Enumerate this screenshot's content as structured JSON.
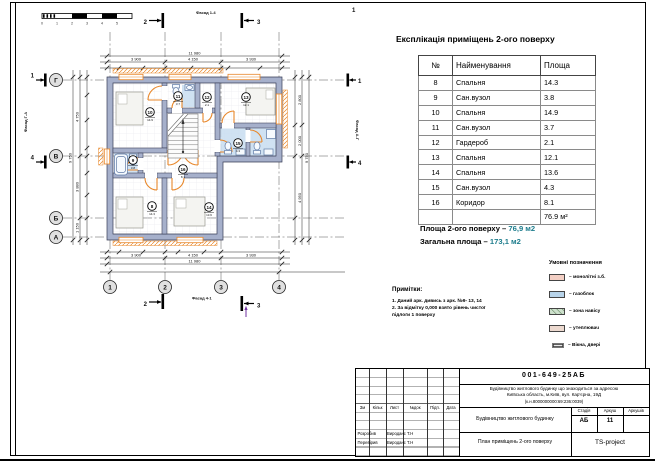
{
  "sheet": {
    "doc_code": "001-649-25АБ",
    "address_line1": "Будівництво житлового будинку що знаходиться за адресою",
    "address_line2": "Київська область, м.Київ, вул. Кар'єрна, 19Д",
    "address_line3": "(к.н.8000000000:69:236:0039)",
    "object_name": "Будівництво житлового будинку",
    "drawing_title": "План приміщень 2-ого поверху",
    "company": "TS-project",
    "stage_label": "Стадія",
    "sheet_label": "Аркуш",
    "sheets_label": "Аркушів",
    "stage": "АБ",
    "sheet_no": "11",
    "rev_cols": [
      "Зм",
      "Кільк",
      "Лист",
      "№док",
      "Підп.",
      "Дата"
    ],
    "roles": [
      {
        "role": "Розробив",
        "name": "Вироданс Т.Н"
      },
      {
        "role": "Перевірив",
        "name": "Вироданс Т.Н"
      }
    ]
  },
  "table": {
    "title": "Експлікація приміщень 2-ого поверху",
    "headers": [
      "№",
      "Найменування",
      "Площа"
    ],
    "rows": [
      {
        "n": "8",
        "name": "Спальня",
        "area": "14.3"
      },
      {
        "n": "9",
        "name": "Сан.вузол",
        "area": "3.8"
      },
      {
        "n": "10",
        "name": "Спальня",
        "area": "14.9"
      },
      {
        "n": "11",
        "name": "Сан.вузол",
        "area": "3.7"
      },
      {
        "n": "12",
        "name": "Гардероб",
        "area": "2.1"
      },
      {
        "n": "13",
        "name": "Спальня",
        "area": "12.1"
      },
      {
        "n": "14",
        "name": "Спальня",
        "area": "13.6"
      },
      {
        "n": "15",
        "name": "Сан.вузол",
        "area": "4.3"
      },
      {
        "n": "16",
        "name": "Коридор",
        "area": "8.1"
      },
      {
        "n": "",
        "name": "",
        "area": "76.9 м²"
      }
    ]
  },
  "summary": {
    "line1_label": "Площа 2-ого поверху –",
    "line1_value": "76,9 м2",
    "line2_label": "Загальна площа –",
    "line2_value": "173,1 м2"
  },
  "legend": {
    "title": "Умовні позначення",
    "items": [
      {
        "label": "– монолітні з.б."
      },
      {
        "label": "– газоблок"
      },
      {
        "label": "– зона навісу"
      },
      {
        "label": "– утеплювач"
      },
      {
        "label": "– Вікна, двері"
      }
    ]
  },
  "notes": {
    "title": "Примітки:",
    "line1": "1. Даний арк. дивись з арк. №9- 13, 14",
    "line2": "2. За відмітку 0,000 взято рівень чистої",
    "line3": "підлоги 1 поверху"
  },
  "plan": {
    "grid_rows": [
      "Г",
      "В",
      "Б",
      "А"
    ],
    "grid_cols": [
      "1",
      "2",
      "3",
      "4"
    ],
    "sections": {
      "s1": "1",
      "s2": "2",
      "s3": "3",
      "s4": "4"
    },
    "facades": {
      "top": "Фасад 1-4",
      "bottom": "Фасад 4-1",
      "left": "Фасад Г-А",
      "right": "Фасад А-Г"
    },
    "scale_ticks": [
      "0",
      "1",
      "2",
      "3",
      "4",
      "5"
    ],
    "purple_mark": "1",
    "tags": [
      {
        "n": "8",
        "area": "14.3"
      },
      {
        "n": "9",
        "area": "3.8"
      },
      {
        "n": "10",
        "area": "14.9"
      },
      {
        "n": "11",
        "area": "3.7"
      },
      {
        "n": "12",
        "area": "2.1"
      },
      {
        "n": "13",
        "area": "12.1"
      },
      {
        "n": "14",
        "area": "13.6"
      },
      {
        "n": "15",
        "area": "4.3"
      },
      {
        "n": "16",
        "area": "8.1"
      }
    ],
    "dims": {
      "top_overall": "11 980",
      "top_spans": [
        "3 900",
        "4 150",
        "3 930"
      ],
      "bottom_overall": "11 980",
      "bottom_spans": [
        "3 900",
        "4 150",
        "3 930"
      ],
      "left_overall": "9 750",
      "left_spans": [
        "4 750",
        "3 880",
        "1 150"
      ],
      "right_overall": "9 750",
      "right_spans": [
        "2 800",
        "2 000",
        "4 950"
      ]
    }
  }
}
